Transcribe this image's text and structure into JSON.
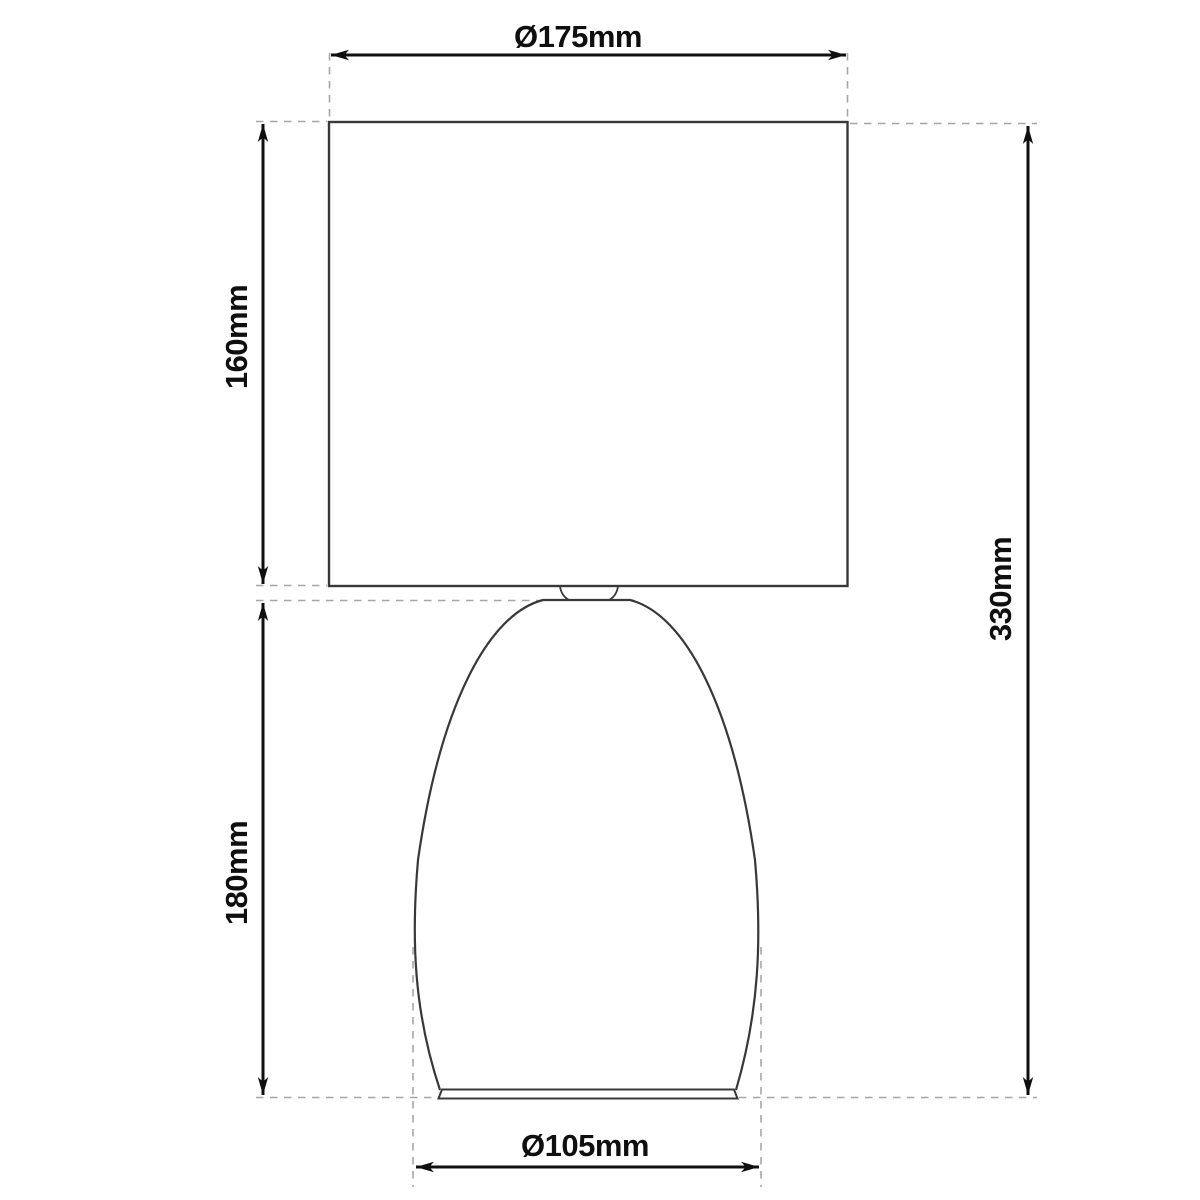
{
  "colors": {
    "background": "#ffffff",
    "outline": "#383838",
    "dimension": "#0f0f0f",
    "extension": "#a6a6a6",
    "text": "#0f0f0f"
  },
  "drawing": {
    "object": "table-lamp",
    "view": "front-elevation-dimension-drawing",
    "dimensions": {
      "shade_diameter": {
        "label": "Ø175mm",
        "value_mm": 175,
        "position": "top"
      },
      "shade_height": {
        "label": "160mm",
        "value_mm": 160,
        "position": "left-upper"
      },
      "body_height": {
        "label": "180mm",
        "value_mm": 180,
        "position": "left-lower"
      },
      "total_height": {
        "label": "330mm",
        "value_mm": 330,
        "position": "right"
      },
      "base_diameter": {
        "label": "Ø105mm",
        "value_mm": 105,
        "position": "bottom"
      }
    }
  }
}
